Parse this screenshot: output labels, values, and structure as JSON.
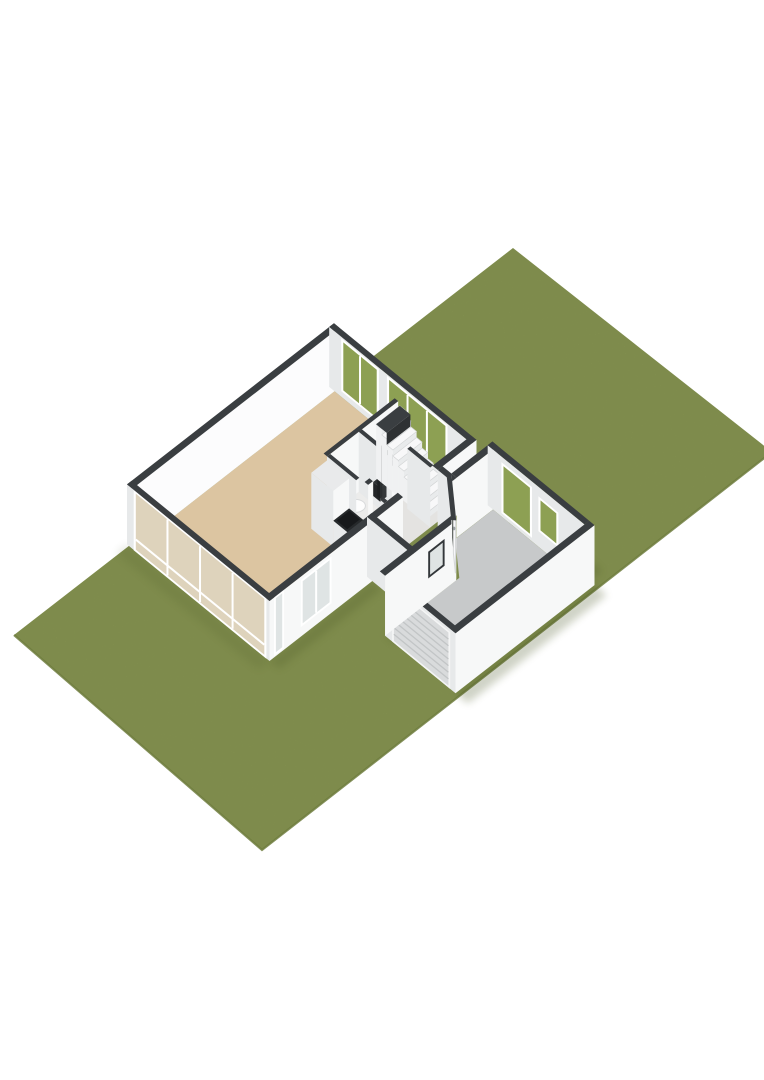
{
  "scene": {
    "canvas": {
      "width": 764,
      "height": 1080
    },
    "palette": {
      "background": "#ffffff",
      "lawn": "#8d9c55",
      "lawnEdge": "#6f7d3e",
      "cap": "#3a3e41",
      "capDark": "#2e3133",
      "wallLight": "#f7f8f8",
      "wallBright": "#fcfcfd",
      "wallShade": "#e7e9ea",
      "livingFloor": "#dcc5a1",
      "hallFloor": "#e4e3e1",
      "wcFloor": "#ececeb",
      "garageFloor": "#c7c9ca",
      "glassGreen": "#8da053",
      "glassPale": "#dfe4e4",
      "glassWest": "#ded3bc",
      "frameWhite": "#ffffff",
      "frameDark": "#33373a",
      "counterTop": "#26292b",
      "cooktop": "#17191b",
      "garageDoor": "#d9dbdc",
      "garageDoorLine": "#c2c5c6",
      "doorLeaf": "#fcfcfd",
      "doorEdge": "#d5d7d8",
      "sidelight": "#565b57",
      "stepTop": "#f8f8f9",
      "stepRiser": "#e9ebec",
      "stepSide": "#f0f1f2",
      "stepEdge": "#d4d6d7",
      "toilet": "#fdfdfd",
      "shadow": "#42501f"
    },
    "iso": {
      "origin": [
        137,
        545
      ],
      "uA": [
        0.79,
        -0.615
      ],
      "uB": [
        0.88,
        0.72
      ],
      "h": 60
    },
    "lawn": {
      "quad": [
        [
          513,
          248
        ],
        [
          772,
          452
        ],
        [
          262,
          850
        ],
        [
          14,
          635
        ]
      ],
      "edgePath": [
        [
          772,
          452
        ],
        [
          262,
          850
        ],
        [
          14,
          635
        ]
      ]
    },
    "shadows": [
      {
        "q": [
          [
            256,
            -6
          ],
          [
            274,
            -6
          ],
          [
            274,
            150
          ],
          [
            256,
            150
          ]
        ],
        "o": 0.22
      },
      {
        "q": [
          [
            265,
            166
          ],
          [
            281,
            166
          ],
          [
            281,
            276
          ],
          [
            265,
            276
          ]
        ],
        "o": 0.25
      },
      {
        "q": [
          [
            89,
            282
          ],
          [
            265,
            282
          ],
          [
            265,
            296
          ],
          [
            89,
            296
          ]
        ],
        "o": 0.25
      },
      {
        "q": [
          [
            89,
            202
          ],
          [
            179,
            202
          ],
          [
            179,
            213
          ],
          [
            89,
            213
          ]
        ],
        "o": 0.2
      },
      {
        "q": [
          [
            -6,
            156
          ],
          [
            124,
            156
          ],
          [
            124,
            167
          ],
          [
            -6,
            167
          ]
        ],
        "o": 0.2
      },
      {
        "q": [
          [
            213,
            156
          ],
          [
            259,
            156
          ],
          [
            259,
            166
          ],
          [
            213,
            166
          ]
        ],
        "o": 0.3
      },
      {
        "q": [
          [
            -20,
            -6
          ],
          [
            -6,
            -6
          ],
          [
            -6,
            156
          ],
          [
            -20,
            156
          ]
        ],
        "o": 0.12
      }
    ],
    "elements": [
      {
        "type": "floor",
        "name": "living-room-floor",
        "fill": "livingFloor",
        "pts": [
          [
            0,
            0
          ],
          [
            250,
            0
          ],
          [
            250,
            81
          ],
          [
            146,
            81
          ],
          [
            146,
            150
          ],
          [
            0,
            150
          ]
        ]
      },
      {
        "type": "wallA",
        "name": "living-back-wall",
        "y": 0,
        "x0": -6,
        "x1": 256,
        "t": 6,
        "fill": "wallBright"
      },
      {
        "type": "wallB",
        "name": "living-ne-window-wall",
        "x": 250,
        "y0": -6,
        "y1": 156,
        "t": 6,
        "fill": "wallShade",
        "windows": [
          {
            "y0": 10,
            "y1": 48,
            "z0": 8,
            "z1": 56,
            "glass": "glassGreen",
            "mullions": [
              29
            ]
          },
          {
            "y0": 62,
            "y1": 126,
            "z0": 8,
            "z1": 56,
            "glass": "glassGreen",
            "mullions": [
              83,
              105
            ]
          }
        ]
      },
      {
        "type": "floor",
        "name": "hall-floor",
        "fill": "hallFloor",
        "pts": [
          [
            146,
            81
          ],
          [
            250,
            81
          ],
          [
            250,
            150
          ],
          [
            146,
            150
          ]
        ]
      },
      {
        "type": "floor",
        "name": "wc-floor",
        "fill": "wcFloor",
        "pts": [
          [
            150,
            85
          ],
          [
            186,
            85
          ],
          [
            186,
            124
          ],
          [
            150,
            124
          ]
        ]
      },
      {
        "type": "wallA",
        "name": "hall-north-partition",
        "y": 85,
        "x0": 146,
        "x1": 236,
        "t": 4,
        "fill": "wallLight"
      },
      {
        "type": "wallB",
        "name": "wc-east-partition",
        "x": 186,
        "y0": 85,
        "y1": 128,
        "t": 4,
        "fill": "wallShade"
      },
      {
        "type": "wallA",
        "name": "wc-south-partition",
        "y": 128,
        "x0": 150,
        "x1": 156,
        "t": 4,
        "fill": "wallLight"
      },
      {
        "type": "wallA",
        "name": "wc-south-partition-2",
        "y": 128,
        "x0": 180,
        "x1": 190,
        "t": 4,
        "fill": "wallLight"
      },
      {
        "type": "box",
        "name": "toilet-tank",
        "x0": 156,
        "y0": 87,
        "x1": 172,
        "y1": 92,
        "h": 14,
        "top": "toilet",
        "faceY": "toilet",
        "faceX": "wallShade"
      },
      {
        "type": "ellipse",
        "name": "toilet-bowl",
        "cx": 164,
        "cy": 101,
        "z": 11,
        "rx": 10,
        "ry": 6.5,
        "fill": "toilet",
        "stroke": "#d8dadb"
      },
      {
        "type": "box",
        "name": "wood-stove",
        "x0": 192,
        "y0": 96,
        "x1": 200,
        "y1": 104,
        "h": 14,
        "top": "#2c2f31",
        "faceY": "#35383a",
        "faceX": "#232527"
      },
      {
        "type": "box",
        "name": "stove-flue",
        "x0": 194.5,
        "y0": 98.5,
        "x1": 197.5,
        "y1": 101.5,
        "h": 48,
        "top": "#222426",
        "faceY": "#2c2f31",
        "faceX": "#1d1f21"
      },
      {
        "type": "stairs",
        "name": "staircase",
        "x0": 208,
        "x1": 238,
        "yStart": 142,
        "dy": 6.33,
        "count": 9,
        "rise": 6
      },
      {
        "type": "flat",
        "name": "staircase-cut-cap",
        "z": 54,
        "fill": "cap",
        "pts": [
          [
            208,
            85
          ],
          [
            238,
            85
          ],
          [
            238,
            97
          ],
          [
            208,
            97
          ]
        ]
      },
      {
        "type": "face",
        "name": "staircase-cut-face",
        "fill": "capDark",
        "pts": [
          [
            208,
            97,
            42
          ],
          [
            238,
            97,
            42
          ],
          [
            238,
            97,
            54
          ],
          [
            208,
            97,
            54
          ]
        ]
      },
      {
        "type": "wallB",
        "name": "stair-partition",
        "x": 204,
        "y0": 124,
        "y1": 150,
        "t": 4,
        "fill": "wallShade"
      },
      {
        "type": "wallB",
        "name": "kitchen-partition",
        "x": 146,
        "y0": 85,
        "y1": 118,
        "t": 4,
        "fill": "wallShade"
      },
      {
        "type": "wallB",
        "name": "kitchen-partition-2",
        "x": 146,
        "y0": 146,
        "y1": 150,
        "t": 4,
        "fill": "wallShade"
      },
      {
        "type": "box",
        "name": "kitchen-tall-cabinet",
        "x0": 126,
        "y0": 85,
        "x1": 146,
        "y1": 110,
        "h": 56,
        "top": "#e9eaeb",
        "faceY": "wallLight",
        "faceX": "wallShade"
      },
      {
        "type": "box",
        "name": "kitchen-counter",
        "x0": 126,
        "y0": 110,
        "x1": 146,
        "y1": 146,
        "h": 26,
        "top": "counterTop",
        "faceY": "#f3f3f4",
        "faceX": "#e8eaeb"
      },
      {
        "type": "flat",
        "name": "cooktop",
        "z": 26.3,
        "fill": "cooktop",
        "pts": [
          [
            128,
            112
          ],
          [
            144,
            112
          ],
          [
            144,
            124
          ],
          [
            128,
            124
          ]
        ]
      },
      {
        "type": "box",
        "name": "kitchen-sink-unit",
        "x0": 129,
        "y0": 128,
        "x1": 143,
        "y1": 141,
        "h": 9,
        "top": "#fbfbfc",
        "faceY": "#f1f2f2",
        "faceX": "#e6e8e9"
      },
      {
        "type": "wallA",
        "name": "living-front-wall",
        "y": 156,
        "x0": -6,
        "x1": 163,
        "t": 6,
        "fill": "wallLight",
        "windows": [
          {
            "x0": 2,
            "x1": 10,
            "z0": 4,
            "z1": 58,
            "glass": "glassPale"
          },
          {
            "x0": 36,
            "x1": 70,
            "z0": 12,
            "z1": 54,
            "glass": "glassPale",
            "mullions": [
              53
            ]
          }
        ]
      },
      {
        "type": "wallA",
        "name": "front-wall-east-segment",
        "y": 156,
        "x0": 207,
        "x1": 256,
        "t": 6,
        "fill": "wallLight"
      },
      {
        "type": "wallB",
        "name": "courtyard-end-wall",
        "x": 207,
        "y0": 156,
        "y1": 172,
        "t": 6,
        "fill": "wallShade"
      },
      {
        "type": "wallB",
        "name": "west-glazed-wall",
        "x": -6,
        "y0": -6,
        "y1": 156,
        "t": 6,
        "fill": "wallShade",
        "windows": [
          {
            "y0": 4,
            "y1": 150,
            "z0": 2,
            "z1": 58,
            "glass": "glassWest",
            "mullions": [
              40,
              77,
              114
            ],
            "transoms": [
              12
            ]
          }
        ]
      },
      {
        "type": "floor",
        "name": "entrance-hall-floor",
        "fill": "hallFloor",
        "pts": [
          [
            130,
            156
          ],
          [
            207,
            156
          ],
          [
            207,
            168
          ],
          [
            179,
            196
          ],
          [
            130,
            196
          ]
        ]
      },
      {
        "type": "wallA",
        "name": "garage-nw-wall",
        "y": 172,
        "x0": 213,
        "x1": 265,
        "t": 6,
        "fill": "wallLight"
      },
      {
        "type": "floor",
        "name": "garage-floor",
        "fill": "garageFloor",
        "pts": [
          [
            95,
            202
          ],
          [
            183,
            202
          ],
          [
            211,
            172
          ],
          [
            259,
            172
          ],
          [
            259,
            276
          ],
          [
            95,
            276
          ]
        ]
      },
      {
        "type": "wallB",
        "name": "garage-ne-window-wall",
        "x": 259,
        "y0": 166,
        "y1": 276,
        "t": 6,
        "fill": "wallShade",
        "windows": [
          {
            "y0": 184,
            "y1": 214,
            "z0": 6,
            "z1": 52,
            "glass": "glassGreen"
          },
          {
            "y0": 226,
            "y1": 244,
            "z0": 18,
            "z1": 48,
            "glass": "glassGreen"
          }
        ]
      },
      {
        "type": "wallA",
        "name": "garage-south-wall",
        "y": 282,
        "x0": 89,
        "x1": 265,
        "t": 6,
        "fill": "wallLight"
      },
      {
        "type": "wallB",
        "name": "garage-west-wall",
        "x": 89,
        "y0": 202,
        "y1": 282,
        "t": 6,
        "fill": "wallShade",
        "slatDoor": {
          "y0": 212,
          "y1": 274,
          "z0": 2,
          "z1": 55,
          "slats": 8,
          "name": "garage-door"
        }
      },
      {
        "type": "wallB",
        "name": "entrance-west-wall",
        "x": 124,
        "y0": 150,
        "y1": 202,
        "t": 6,
        "fill": "wallShade"
      },
      {
        "type": "wallA",
        "name": "entrance-front-wall",
        "y": 202,
        "x0": 89,
        "x1": 179,
        "t": 6,
        "fill": "wallLight",
        "windows": [
          {
            "x0": 146,
            "x1": 162,
            "z0": 26,
            "z1": 48,
            "glass": "glassPale",
            "frame": "dark"
          }
        ]
      },
      {
        "type": "chamfer",
        "name": "entrance-chamfer-wall",
        "outer": [
          [
            179,
            202
          ],
          [
            213,
            166
          ]
        ],
        "t": 4.2,
        "fill": "wallLight",
        "door": {
          "t0": 0.16,
          "t1": 0.58,
          "name": "front-door"
        },
        "sidelight": {
          "t0": 0.63,
          "t1": 0.85
        }
      }
    ]
  }
}
